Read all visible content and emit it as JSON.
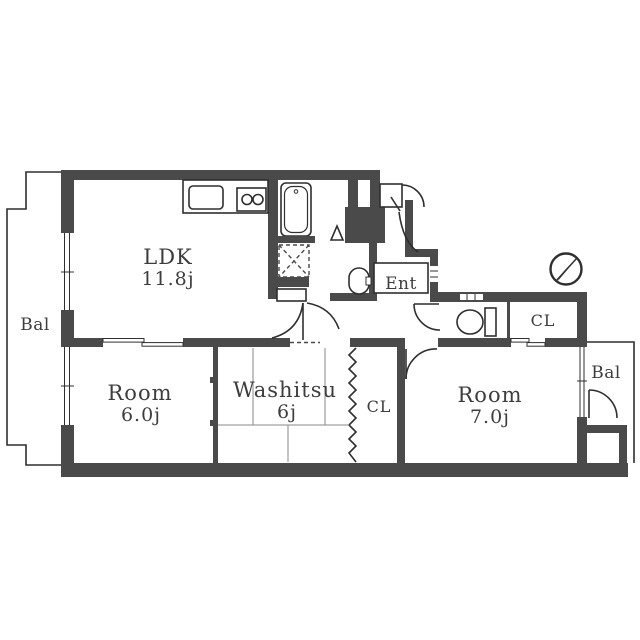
{
  "title": "Apartment floor plan",
  "colors": {
    "wall": "#4a4a4a",
    "line": "#2f2f2f",
    "background": "#ffffff",
    "text": "#3d3d3d"
  },
  "rooms": {
    "ldk": {
      "name": "LDK",
      "size": "11.8j"
    },
    "room6": {
      "name": "Room",
      "size": "6.0j"
    },
    "washitsu": {
      "name": "Washitsu",
      "size": "6j"
    },
    "room7": {
      "name": "Room",
      "size": "7.0j"
    },
    "closet_hall": {
      "label": "CL"
    },
    "closet_washitsu": {
      "label": "CL"
    },
    "entrance": {
      "label": "Ent"
    },
    "balcony_left": {
      "label": "Bal"
    },
    "balcony_right": {
      "label": "Bal"
    }
  },
  "icons": {
    "compass": "compass-north-needle",
    "bathtub": "bathtub",
    "toilet": "toilet",
    "washbasin": "washbasin",
    "sink": "kitchen-sink",
    "stove": "two-burner-stove",
    "washer": "washing-machine-space"
  }
}
